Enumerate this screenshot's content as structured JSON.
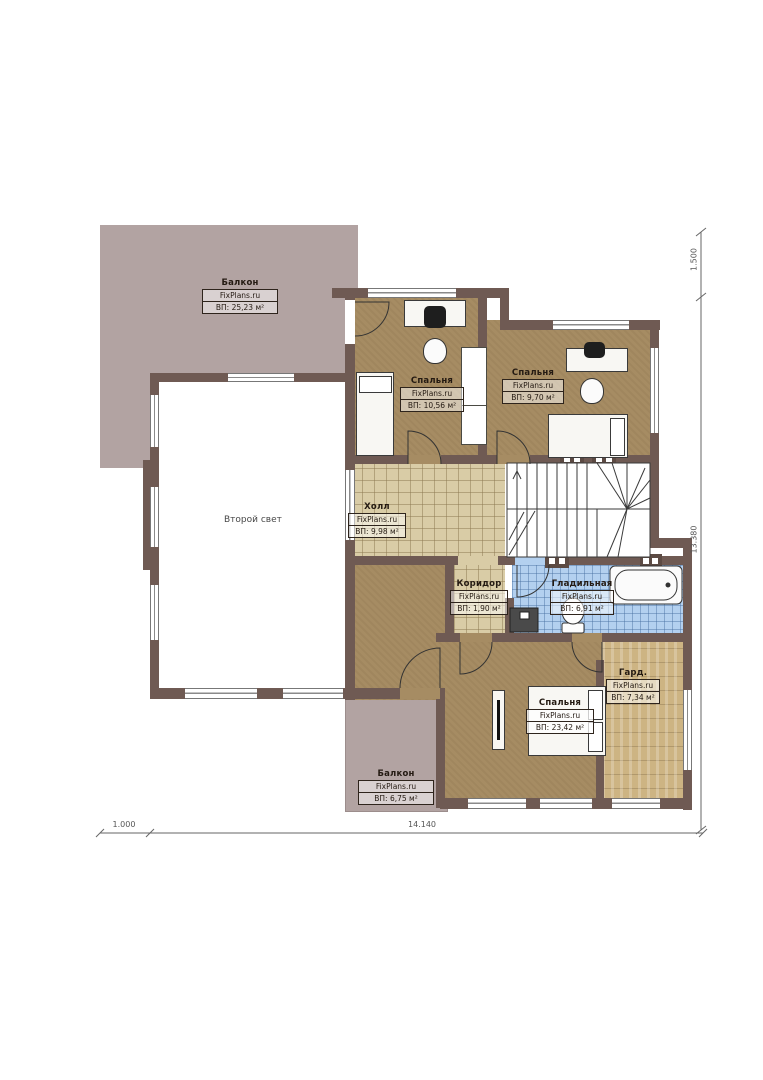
{
  "plan": {
    "brand": "FixPlans.ru",
    "rooms": [
      {
        "id": "balcony-top",
        "name": "Балкон",
        "brand": "FixPlans.ru",
        "area": "ВП: 25,23 м²"
      },
      {
        "id": "bedroom-1",
        "name": "Спальня",
        "brand": "FixPlans.ru",
        "area": "ВП: 10,56 м²"
      },
      {
        "id": "bedroom-2",
        "name": "Спальня",
        "brand": "FixPlans.ru",
        "area": "ВП: 9,70 м²"
      },
      {
        "id": "hall",
        "name": "Холл",
        "brand": "FixPlans.ru",
        "area": "ВП: 9,98 м²"
      },
      {
        "id": "corridor",
        "name": "Коридор",
        "brand": "FixPlans.ru",
        "area": "ВП: 1,90 м²"
      },
      {
        "id": "ironing-room",
        "name": "Гладильная",
        "brand": "FixPlans.ru",
        "area": "ВП: 6,91 м²"
      },
      {
        "id": "wardrobe",
        "name": "Гард.",
        "brand": "FixPlans.ru",
        "area": "ВП: 7,34 м²"
      },
      {
        "id": "bedroom-3",
        "name": "Спальня",
        "brand": "FixPlans.ru",
        "area": "ВП: 23,42 м²"
      },
      {
        "id": "balcony-bottom",
        "name": "Балкон",
        "brand": "FixPlans.ru",
        "area": "ВП: 6,75 м²"
      },
      {
        "id": "second-light",
        "name": "Второй свет"
      }
    ],
    "dimensions": {
      "top_right": "1.500",
      "right": "13.380",
      "bottom": "14.140",
      "bottom_left": "1.000"
    },
    "colors": {
      "wall": "#6f5a53",
      "balcony": "#b2a3a2",
      "bedroom_floor": "#a68c63",
      "hall_floor": "#d9cca6",
      "bath_floor": "#b3d0ef",
      "wardrobe_floor": "#cdb483"
    }
  }
}
